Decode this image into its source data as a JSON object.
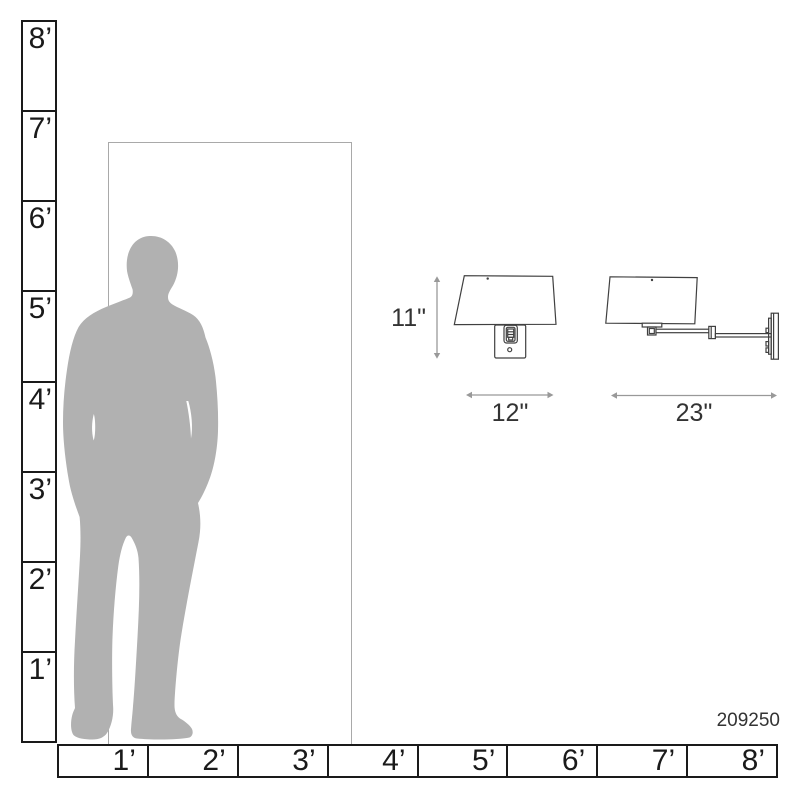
{
  "diagram": {
    "product_number": "209250",
    "description_labels": {
      "fixture_height": "11\"",
      "fixture_width": "12\"",
      "fixture_extension": "23\""
    }
  },
  "rulers": {
    "vertical": {
      "labels": [
        "8’",
        "7’",
        "6’",
        "5’",
        "4’",
        "3’",
        "2’",
        "1’"
      ]
    },
    "horizontal": {
      "labels": [
        "1’",
        "2’",
        "3’",
        "4’",
        "5’",
        "6’",
        "7’",
        "8’"
      ]
    }
  },
  "colors": {
    "ruler_line": "#1a1a1a",
    "ruler_text": "#1a1a1a",
    "door_line": "#a9a9a9",
    "silhouette": "#b1b1b1",
    "lamp_line": "#404040",
    "arrow": "#999999",
    "label_text": "#333333",
    "bg": "#ffffff"
  }
}
